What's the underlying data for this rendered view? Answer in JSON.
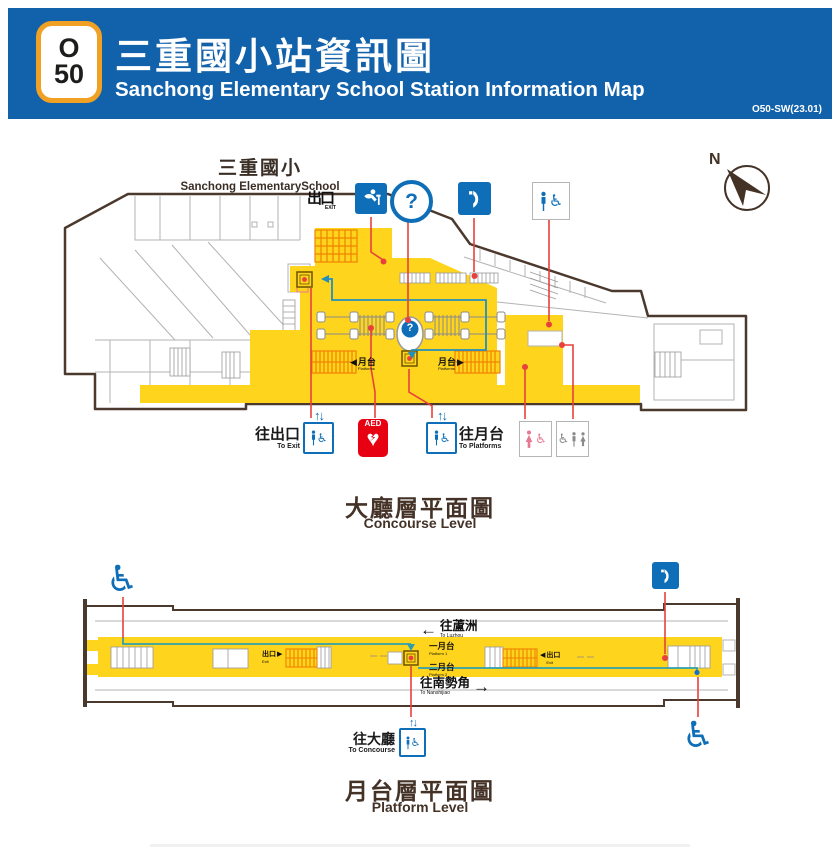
{
  "header": {
    "line_badge": {
      "line_letter": "O",
      "station_number": "50"
    },
    "title_zh": "三重國小站資訊圖",
    "title_en": "Sanchong Elementary School Station Information Map",
    "version_code": "O50-SW(23.01)"
  },
  "compass": {
    "north_label": "N"
  },
  "concourse": {
    "landmark": {
      "zh": "三重國小",
      "en": "Sanchong ElementarySchool"
    },
    "exit_sign": {
      "zh": "出口",
      "en": "EXIT"
    },
    "gate_label": {
      "zh": "月台",
      "en": "Platforms"
    },
    "to_exit": {
      "zh": "往出口",
      "en": "To Exit"
    },
    "to_platforms": {
      "zh": "往月台",
      "en": "To Platforms"
    },
    "aed_label": "AED",
    "section_title": {
      "zh": "大廳層平面圖",
      "en": "Concourse Level"
    }
  },
  "platform": {
    "to_luzhou": {
      "zh": "往蘆洲",
      "en": "To Luzhou"
    },
    "platform1": {
      "zh": "一月台",
      "en": "Platform 1"
    },
    "platform2": {
      "zh": "二月台",
      "en": "Platform 2"
    },
    "to_nanshijiao": {
      "zh": "往南勢角",
      "en": "To Nanshijiao"
    },
    "exit_label": {
      "zh": "出口",
      "en": "Exit"
    },
    "to_concourse": {
      "zh": "往大廳",
      "en": "To Concourse"
    },
    "section_title": {
      "zh": "月台層平面圖",
      "en": "Platform Level"
    }
  },
  "glyphs": {
    "question": "?",
    "wheelchair": "♿",
    "heart": "♥",
    "bolt": "⚡",
    "up_down": "↑↓",
    "arrow_left": "←",
    "arrow_right": "→",
    "tri_left": "◀",
    "tri_right": "▶"
  },
  "icons": [
    "drinking-fountain",
    "information",
    "public-telephone",
    "accessible-restroom",
    "elevator",
    "aed",
    "womens-accessible-restroom",
    "family-accessible-restroom",
    "wheelchair",
    "north-compass"
  ],
  "colors": {
    "header_blue": "#1161ab",
    "line_orange": "#f0a124",
    "paid_area_yellow": "#ffd41d",
    "escalator_orange": "#ef8200",
    "pictogram_blue": "#0e6eb8",
    "leader_red": "#e8413c",
    "aed_red": "#e60012",
    "path_teal": "#2090c0",
    "womens_pink": "#e8788f",
    "outline_brown": "#4a392c",
    "title_brown": "#443227"
  }
}
